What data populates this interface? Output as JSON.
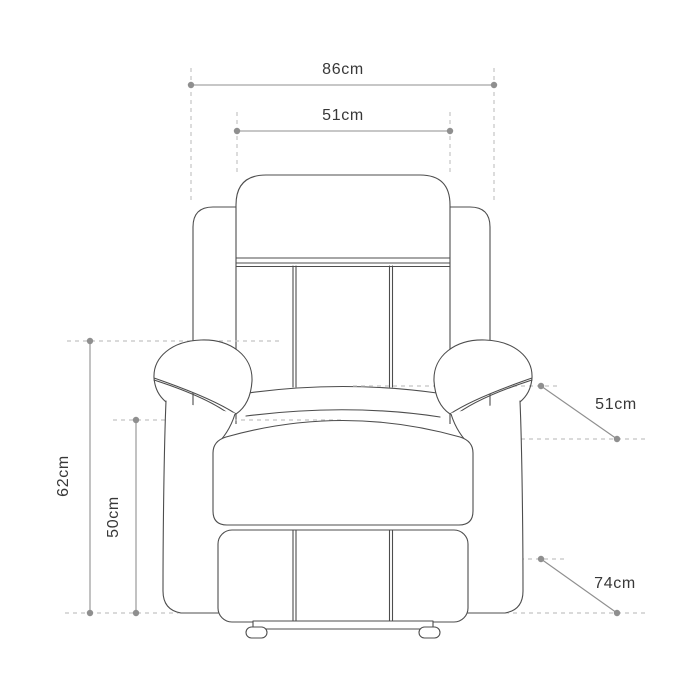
{
  "diagram": {
    "subject": "Recliner armchair front-view dimension drawing",
    "background_color": "#ffffff",
    "labels": {
      "overall_width": "86cm",
      "backrest_width": "51cm",
      "left_outer_height": "62cm",
      "left_inner_height": "50cm",
      "right_upper": "51cm",
      "right_lower": "74cm"
    },
    "colors": {
      "chair_outline": "#4d4d4d",
      "dimension_line": "#8f8f8f",
      "dashed_guide": "#c4c4c4",
      "label_text": "#383838"
    }
  }
}
